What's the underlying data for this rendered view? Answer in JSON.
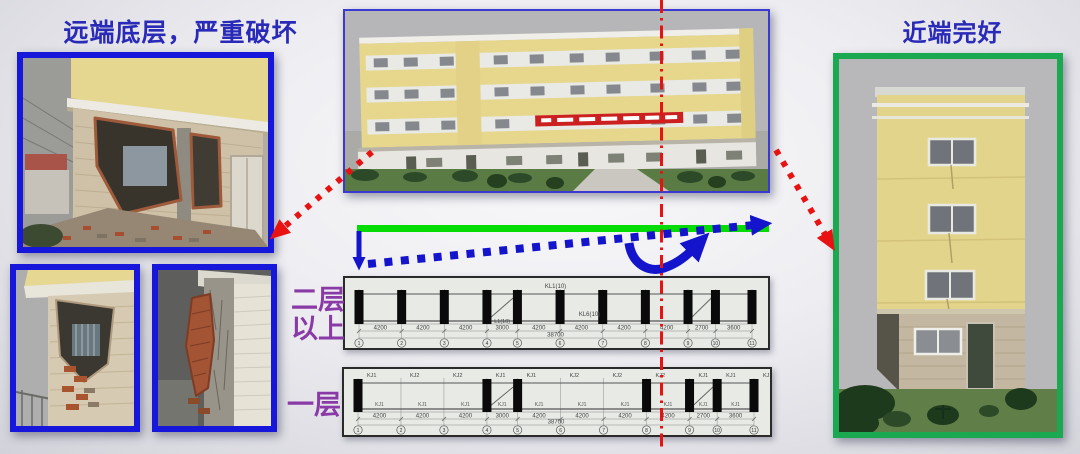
{
  "slide": {
    "title_left": "远端底层，严重破坏",
    "title_right": "近端完好",
    "label_upper_line1": "二层",
    "label_upper_line2": "以上",
    "label_lower": "一层"
  },
  "colors": {
    "title_blue": "#2a2ab8",
    "photo_border_blue": "#1717dc",
    "photo_border_green": "#1aa850",
    "beam_green": "#04dc04",
    "arrow_blue": "#1414cc",
    "axis_red": "#e81212",
    "label_purple": "#8a3aa6"
  },
  "drawings": {
    "dims": [
      "4200",
      "4200",
      "4200",
      "3000",
      "4200",
      "4200",
      "4200",
      "4200",
      "2700",
      "3600"
    ],
    "total": "38700",
    "grid_numbers": [
      "1",
      "2",
      "3",
      "4",
      "5",
      "6",
      "7",
      "8",
      "9",
      "10",
      "11"
    ],
    "upper": {
      "beam_label_top": "KL1(10)",
      "beam_label_mid": "KL6(10)",
      "bay_label": "L1(10)",
      "bar_grids": [
        0,
        1,
        2,
        3,
        4,
        5,
        6,
        7,
        8,
        9,
        10
      ]
    },
    "lower": {
      "top_labels": [
        "KJ1",
        "KJ2",
        "KJ2",
        "KJ1",
        "KJ1",
        "KJ2",
        "KJ2",
        "KJ2",
        "KJ1",
        "KJ1",
        "KJ1"
      ],
      "mid_label": "KJ1",
      "bar_grids": [
        0,
        3,
        4,
        7,
        8,
        9,
        10
      ]
    }
  }
}
